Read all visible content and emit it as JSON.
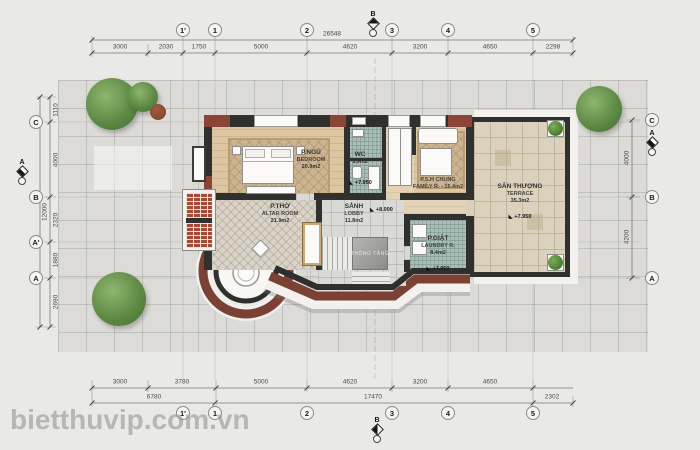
{
  "watermark": "bietthuvip.com.vn",
  "grid": {
    "cols": [
      "1'",
      "1",
      "2",
      "3",
      "4",
      "5"
    ],
    "rows_left": [
      "C",
      "B",
      "A'",
      "A"
    ],
    "rows_right": [
      "C",
      "B",
      "A"
    ]
  },
  "sections": {
    "b": "B",
    "a": "A"
  },
  "dims": {
    "top_total": "26548",
    "top": [
      "3000",
      "2030",
      "1750",
      "5000",
      "4620",
      "3200",
      "4650",
      "2298"
    ],
    "bottom": [
      "3000",
      "3780",
      "5000",
      "4620",
      "3200",
      "4650"
    ],
    "bottom_totals": [
      "6780",
      "17470",
      "2302"
    ],
    "left": [
      "1110",
      "4000",
      "2320",
      "1880",
      "2690"
    ],
    "left_total": "12000",
    "right": [
      "4000",
      "4200"
    ]
  },
  "rooms": {
    "bedroom": {
      "name": "P.NGỦ",
      "en": "BEDROOM",
      "area": "20.9m2"
    },
    "wc": {
      "name": "WC",
      "area": "5.9m2",
      "level": "+7.950"
    },
    "family": {
      "name": "P.S.H CHUNG",
      "en": "FAMILY R. - 15.4m2"
    },
    "terrace": {
      "name": "SÂN THƯỢNG",
      "en": "TERRACE",
      "area": "35.3m2",
      "level": "+7.950"
    },
    "altar": {
      "name": "P.THỜ",
      "en": "ALTAR ROOM",
      "area": "21.9m2"
    },
    "lobby": {
      "name": "SẢNH",
      "en": "LOBBY",
      "area": "11.8m2",
      "level": "+8.000"
    },
    "laundry": {
      "name": "P.GIẶT",
      "en": "LAUNDRY R.",
      "area": "8.4m2",
      "level": "+7.950"
    },
    "void": {
      "name": "THÔNG TẦNG"
    }
  },
  "palette": {
    "wall": "#30302e",
    "brick_red": "#8a4538",
    "band_red": "#7b4134",
    "mosaic_teal": "#aabdb7",
    "wood": "#dcc7a2",
    "terrace_tile": "#dbd2bd"
  }
}
